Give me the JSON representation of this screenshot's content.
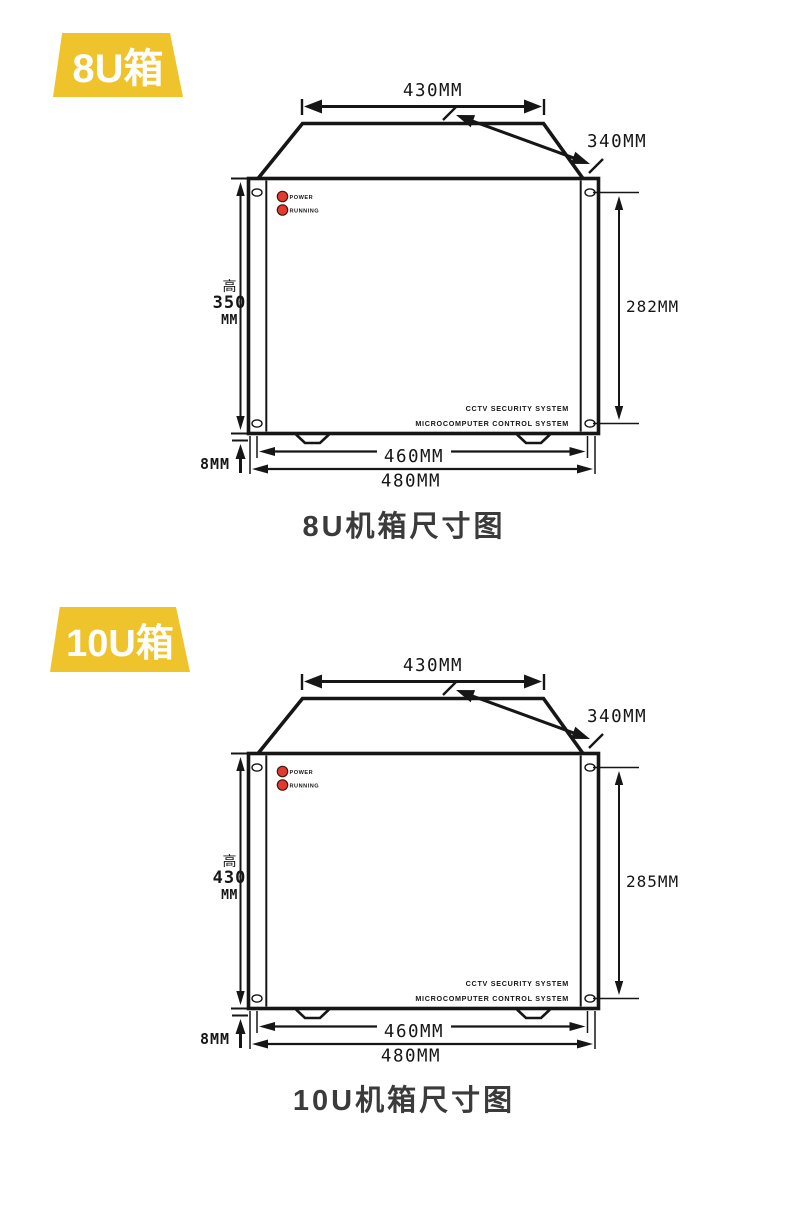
{
  "colors": {
    "badge_yellow": "#EFC32B",
    "led_red": "#E23B2E",
    "line_ink": "#161616",
    "caption_gray": "#3B3B3B"
  },
  "sections": [
    {
      "badge_label": "8U箱",
      "caption": "8U机箱尺寸图",
      "dims": {
        "top_width": "430MM",
        "depth": "340MM",
        "height_label": "高",
        "height_value": "350",
        "height_unit": "MM",
        "mount_height": "282MM",
        "inner_width": "460MM",
        "outer_width": "480MM",
        "foot_height": "8MM"
      },
      "panel": {
        "led_power": "POWER",
        "led_running": "RUNNING",
        "brand_line1": "CCTV SECURITY SYSTEM",
        "brand_line2": "MICROCOMPUTER CONTROL SYSTEM"
      }
    },
    {
      "badge_label": "10U箱",
      "caption": "10U机箱尺寸图",
      "dims": {
        "top_width": "430MM",
        "depth": "340MM",
        "height_label": "高",
        "height_value": "430",
        "height_unit": "MM",
        "mount_height": "285MM",
        "inner_width": "460MM",
        "outer_width": "480MM",
        "foot_height": "8MM"
      },
      "panel": {
        "led_power": "POWER",
        "led_running": "RUNNING",
        "brand_line1": "CCTV SECURITY SYSTEM",
        "brand_line2": "MICROCOMPUTER CONTROL SYSTEM"
      }
    }
  ]
}
